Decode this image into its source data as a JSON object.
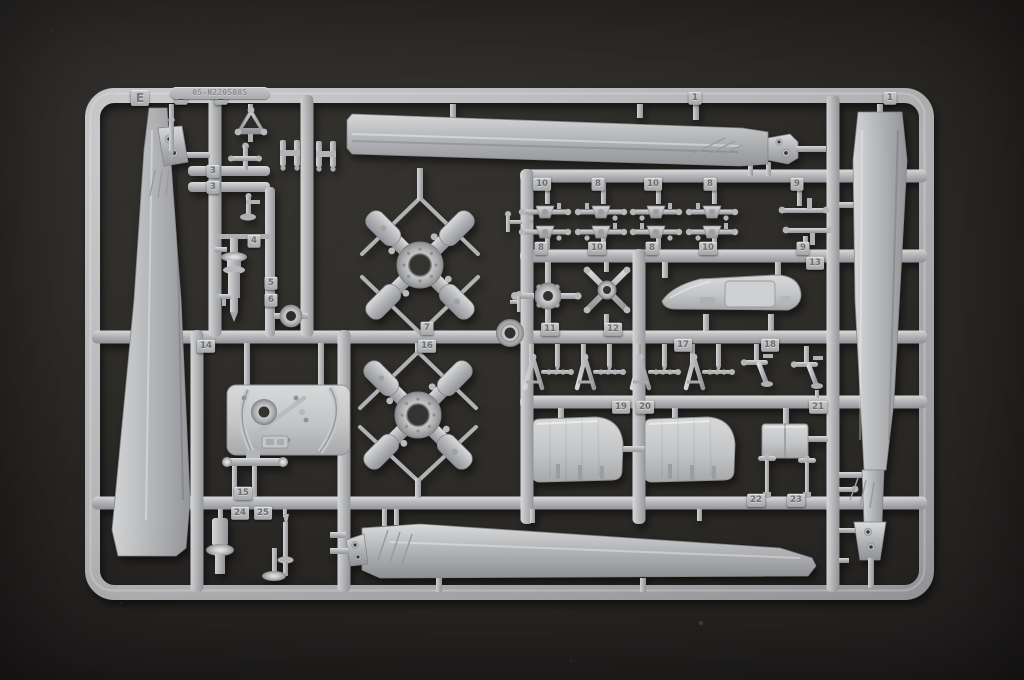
{
  "scene": {
    "type": "photograph",
    "subject": "Gray injection-molded plastic model kit sprue with helicopter rotor blades, rotor hubs and small parts, photographed on a dark charcoal surface",
    "background_color": "#2c2a27",
    "plastic_color": "#b4b6b8"
  },
  "sprue": {
    "letter": "E",
    "mold_code": "05-H2205085",
    "part_tags": [
      {
        "label": "1",
        "x": 181,
        "y": 98
      },
      {
        "label": "2",
        "x": 221,
        "y": 98
      },
      {
        "label": "1",
        "x": 695,
        "y": 98
      },
      {
        "label": "1",
        "x": 890,
        "y": 98
      },
      {
        "label": "3",
        "x": 213,
        "y": 171
      },
      {
        "label": "3",
        "x": 213,
        "y": 187
      },
      {
        "label": "4",
        "x": 254,
        "y": 241
      },
      {
        "label": "5",
        "x": 271,
        "y": 283
      },
      {
        "label": "6",
        "x": 271,
        "y": 300
      },
      {
        "label": "10",
        "x": 542,
        "y": 184
      },
      {
        "label": "8",
        "x": 598,
        "y": 184
      },
      {
        "label": "10",
        "x": 653,
        "y": 184
      },
      {
        "label": "8",
        "x": 710,
        "y": 184
      },
      {
        "label": "9",
        "x": 797,
        "y": 184
      },
      {
        "label": "8",
        "x": 541,
        "y": 248
      },
      {
        "label": "10",
        "x": 597,
        "y": 248
      },
      {
        "label": "8",
        "x": 652,
        "y": 248
      },
      {
        "label": "10",
        "x": 708,
        "y": 248
      },
      {
        "label": "9",
        "x": 803,
        "y": 248
      },
      {
        "label": "13",
        "x": 815,
        "y": 263
      },
      {
        "label": "11",
        "x": 550,
        "y": 329
      },
      {
        "label": "12",
        "x": 613,
        "y": 329
      },
      {
        "label": "7",
        "x": 427,
        "y": 328
      },
      {
        "label": "16",
        "x": 427,
        "y": 346
      },
      {
        "label": "14",
        "x": 206,
        "y": 346
      },
      {
        "label": "17",
        "x": 683,
        "y": 345
      },
      {
        "label": "18",
        "x": 770,
        "y": 345
      },
      {
        "label": "19",
        "x": 621,
        "y": 407
      },
      {
        "label": "20",
        "x": 645,
        "y": 407
      },
      {
        "label": "21",
        "x": 818,
        "y": 407
      },
      {
        "label": "22",
        "x": 756,
        "y": 500
      },
      {
        "label": "23",
        "x": 796,
        "y": 500
      },
      {
        "label": "15",
        "x": 243,
        "y": 493
      },
      {
        "label": "24",
        "x": 240,
        "y": 513
      },
      {
        "label": "25",
        "x": 263,
        "y": 513
      }
    ]
  }
}
